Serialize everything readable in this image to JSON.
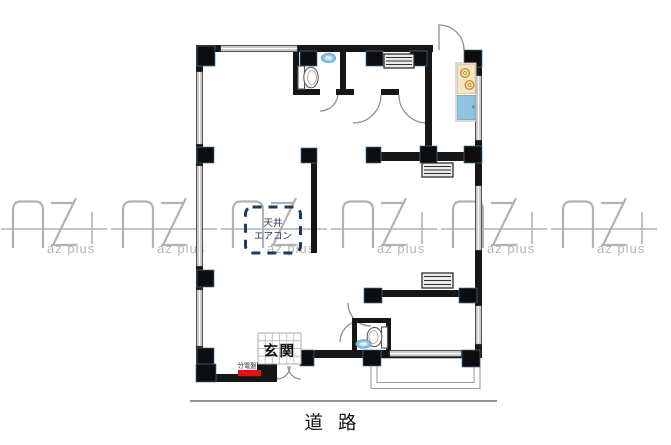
{
  "watermark": {
    "brand": "AZ+",
    "text": "az plus"
  },
  "floor_plan": {
    "labels": {
      "ceiling_aircon": [
        "天井",
        "エアコン"
      ],
      "entrance": "玄関",
      "distribution_board": "分電盤",
      "road": "道路"
    },
    "colors": {
      "wall": "#161616",
      "column": "#0d0d0d",
      "window_gray": "#cdcdcd",
      "door_arc_gray": "#8f8f8f",
      "watermark_gray": "#b2b2b2",
      "distribution_board_red": "#e01112",
      "aircon_dash_navy": "#1d3a63",
      "aircon_text_navy": "#21395c",
      "fixture_blue": "#8fc3e4",
      "fixture_blue_inner": "#d8ecf7",
      "stove_cream": "#f6e4c3",
      "burner_orange": "#c8922f"
    }
  }
}
